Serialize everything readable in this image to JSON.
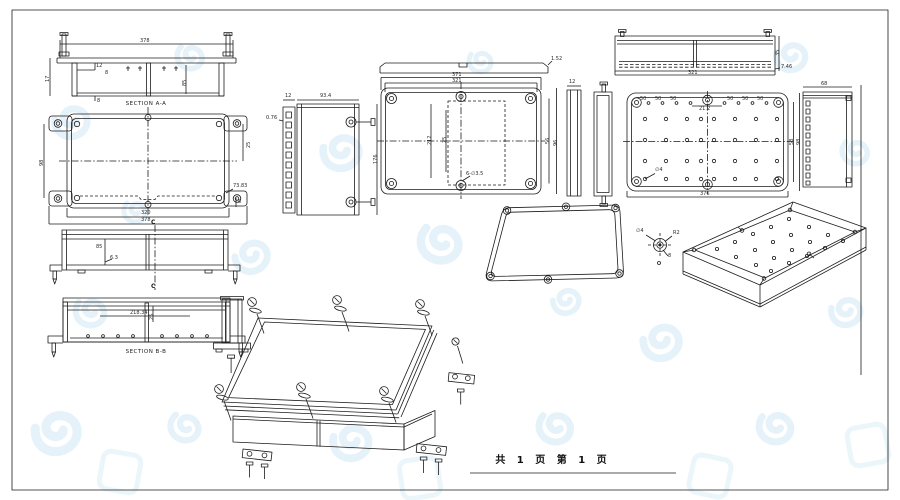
{
  "sheet": {
    "footer_text": "共 1 页  第 1 页"
  },
  "views": {
    "section_a": {
      "label": "SECTION A-A",
      "dim_width": "378",
      "dim_height": "17",
      "dim_depth": "85",
      "dim_s1": "12",
      "dim_s2": "8",
      "dim_s3": "8"
    },
    "lid_top": {
      "dim_left": "98",
      "dim_right": "25",
      "note": "73.83",
      "dim_edge": "8",
      "dim_bottom_inner": "320",
      "dim_bottom_outer": "378"
    },
    "side_c": {
      "marker_top": "C",
      "marker_bottom": "C",
      "dim_inner": "85",
      "dim_hole": "6.3"
    },
    "section_b": {
      "label": "SECTION B-B",
      "dim_width": "218.34",
      "dim_s1": "25"
    },
    "side_left": {
      "dim_s1": "12",
      "dim_top": "93.4",
      "dim_wall": "0.76",
      "dim_height": "176"
    },
    "strip_top": {
      "note": "1.52"
    },
    "cover": {
      "dim_top_outer": "371",
      "dim_top_inner": "321",
      "dim_right_inner": "56",
      "dim_right_outer": "96",
      "dim_v1": "212",
      "dim_v2": "25",
      "note": "6-∅3.5"
    },
    "strip_r1": {
      "dim": "12"
    },
    "box_top": {
      "dim_width": "321",
      "dim_height": "35",
      "note": "7.46"
    },
    "base": {
      "spacing": [
        "50",
        "50",
        "50",
        "50",
        "50",
        "50"
      ],
      "dim_center": "21.2",
      "dim_width": "376",
      "dim_right_inner": "58",
      "dim_right_outer": "98",
      "note": "∅4"
    },
    "side_right": {
      "dim_top": "68"
    },
    "detail": {
      "l1": "∅4",
      "l2": "R2",
      "l3": "8"
    }
  }
}
